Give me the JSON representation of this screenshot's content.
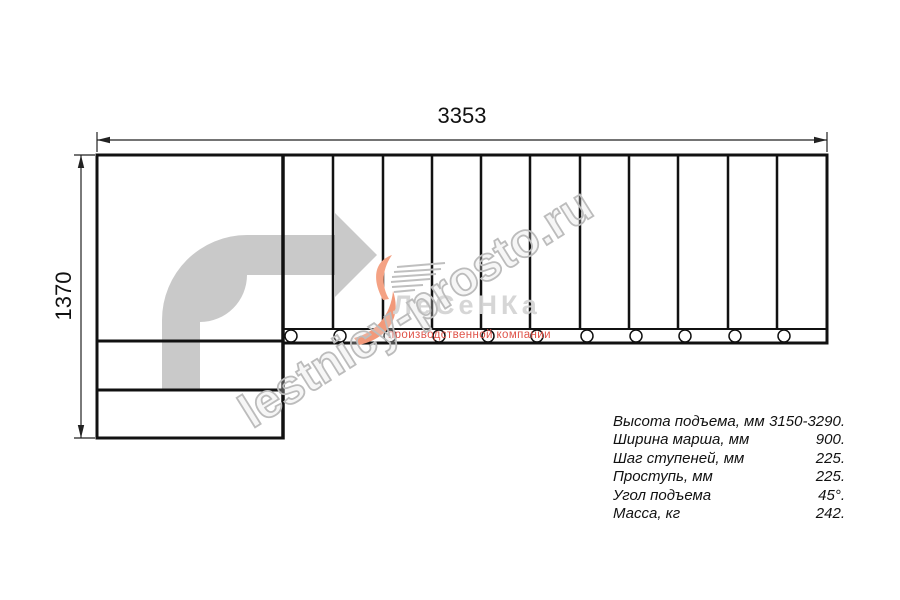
{
  "dimensions": {
    "width_label": "3353",
    "height_label": "1370"
  },
  "drawing": {
    "type": "staircase-top-view",
    "treads_count": 11,
    "mount_holes_count": 11,
    "direction_arrow": "up-then-right",
    "colors": {
      "line": "#111111",
      "arrow_fill": "#c9c9c9",
      "watermark_gray": "#bcbcbc",
      "logo_orange": "#f2997a",
      "logo_gray": "#d4d4d4",
      "logo_red": "#e0544a"
    }
  },
  "specs": {
    "rows": [
      {
        "label": "Высота подъема, мм",
        "value": "3150-3290."
      },
      {
        "label": "Ширина марша, мм",
        "value": "900."
      },
      {
        "label": "Шаг ступеней, мм",
        "value": "225."
      },
      {
        "label": "Проступь, мм",
        "value": "225."
      },
      {
        "label": "Угол подъема",
        "value": "45°."
      },
      {
        "label": "Масса, кг",
        "value": "242."
      }
    ]
  },
  "watermark": {
    "text": "lestnicy-prosto.ru"
  },
  "logo": {
    "name": "ЛеСеНКа",
    "tagline": "производственной компании"
  }
}
